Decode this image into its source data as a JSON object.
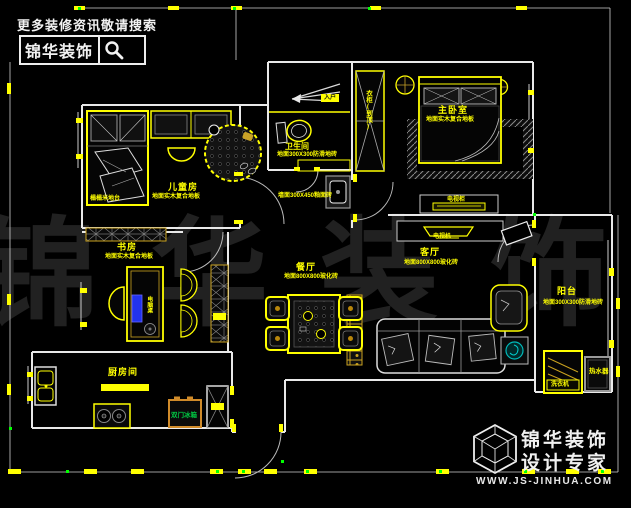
{
  "header": {
    "tagline": "更多装修资讯敬请搜索",
    "logo": "锦华装饰"
  },
  "watermark": "锦华装饰",
  "footer": {
    "logo_line1": "锦华装饰",
    "logo_line2": "设计专家",
    "website": "WWW.JS-JINHUA.COM"
  },
  "rooms": {
    "children": {
      "name": "儿童房",
      "desc": "地面实木复合地板",
      "bed_note": "榻榻米地台"
    },
    "bathroom": {
      "name": "卫生间",
      "desc": "地面300X300防滑地砖",
      "floor_note": "墙面300X450釉面砖"
    },
    "master": {
      "name": "主卧室",
      "desc": "地面实木复合地板",
      "wardrobe": "衣柜(到顶)",
      "tv_cabinet": "电视柜"
    },
    "living": {
      "name": "客厅",
      "desc": "地面800X800玻化砖",
      "tv": "电视机"
    },
    "dining": {
      "name": "餐厅",
      "desc": "地面800X800玻化砖"
    },
    "study": {
      "name": "书房",
      "desc": "地面实木复合地板",
      "desk": "电脑桌"
    },
    "kitchen": {
      "name": "厨房间",
      "fridge": "双门冰箱"
    },
    "balcony": {
      "name": "阳台",
      "desc": "地面300X300防滑地砖",
      "washer": "洗衣机",
      "heater": "热水器"
    },
    "entry": {
      "label": "入户"
    }
  },
  "colors": {
    "wall_line": "#e9e9e9",
    "furniture": "#ffff00",
    "dimension_tick": "#ffff00",
    "marker_green": "#00ff00",
    "fridge_border": "#d08b2a",
    "fridge_text": "#00cc44",
    "monitor_blue": "#2233ee",
    "plant_cyan": "#00c8c8"
  }
}
